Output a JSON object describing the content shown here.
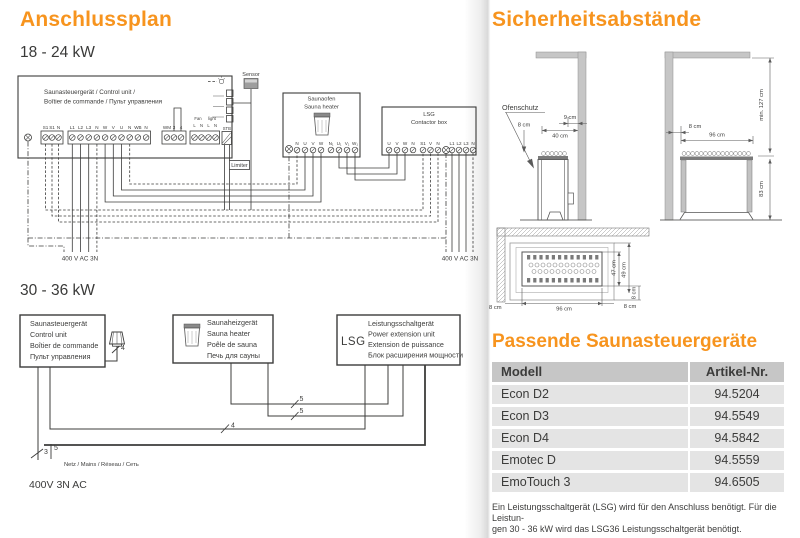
{
  "page": {
    "left_title": "Anschlussplan",
    "right_title": "Sicherheitsabstände",
    "section_18_24": "18 - 24 kW",
    "section_30_36": "30 - 36 kW",
    "accent_color": "#F7941E",
    "text_color": "#3C3C3B"
  },
  "d1": {
    "cu": {
      "label1": "Saunasteuergerät / Control unit /",
      "label2": "Boîtier de commande / Пульт управления",
      "ta": [
        "S1",
        "S1",
        "N"
      ],
      "tb": [
        "L1",
        "L2",
        "L3",
        "N",
        "W",
        "V",
        "U",
        "N",
        "WB",
        "N"
      ],
      "tc": [
        "WM",
        "3",
        "4"
      ],
      "td": [
        "L",
        "N",
        "L",
        "N"
      ],
      "fan": "Fan",
      "light": "light",
      "stb": "STB",
      "limiter": "Limiter"
    },
    "sensor": "Sensor",
    "heater": {
      "label1": "Saunaofen",
      "label2": "Sauna heater",
      "t1": [
        "N",
        "U",
        "V",
        "W"
      ],
      "t2": [
        "N₁",
        "U₁",
        "V₁",
        "W₁"
      ]
    },
    "lsg": {
      "label1": "LSG",
      "label2": "Contactor box",
      "t1": [
        "U",
        "V",
        "W",
        "N"
      ],
      "t2": [
        "S1",
        "V",
        "N"
      ],
      "t3": [
        "L1",
        "L2",
        "L3",
        "N"
      ]
    },
    "supply_left": "400 V AC 3N",
    "supply_right": "400 V AC 3N"
  },
  "d2": {
    "cu_lines": [
      "Saunasteuergerät",
      "Control unit",
      "Boîtier de commande",
      "Пульт управления"
    ],
    "heater_lines": [
      "Saunaheizgerät",
      "Sauna heater",
      "Poêle de sauna",
      "Печь для сауны"
    ],
    "lsg_abbr": "LSG",
    "lsg_lines": [
      "Leistungsschaltgerät",
      "Power extension unit",
      "Extension de puissance",
      "Блок расширения мощности"
    ],
    "wire_sensor": "4",
    "wire_heater_a": "5",
    "wire_heater_b": "5",
    "wire_lsg": "4",
    "wire_mains_a": "3",
    "wire_mains_b": "5",
    "mains_label": "Netz / Mains / Réseau / Сеть",
    "supply": "400V 3N AC"
  },
  "safety": {
    "ofenschutz": "Ofenschutz",
    "front": {
      "d8": "8 cm",
      "d9": "9 cm",
      "d40": "40 cm"
    },
    "side": {
      "d8": "8 cm",
      "d96": "96 cm",
      "d127": "min. 127 cm",
      "d83": "83 cm"
    },
    "top": {
      "d47": "47 cm",
      "d49": "49 cm",
      "d8a": "8 cm",
      "d8left": "8 cm",
      "d96": "96 cm",
      "d8right": "8 cm"
    }
  },
  "controls": {
    "title": "Passende Saunasteuergeräte",
    "table": {
      "headers": [
        "Modell",
        "Artikel-Nr."
      ],
      "rows": [
        [
          "Econ D2",
          "94.5204"
        ],
        [
          "Econ D3",
          "94.5549"
        ],
        [
          "Econ D4",
          "94.5842"
        ],
        [
          "Emotec D",
          "94.5559"
        ],
        [
          "EmoTouch 3",
          "94.6505"
        ]
      ]
    },
    "footnote1": "Ein Leistungsschaltgerät (LSG) wird für den Anschluss benötigt. Für die Leistun-",
    "footnote2": "gen 30 - 36 kW wird das LSG36 Leistungsschaltgerät benötigt."
  }
}
